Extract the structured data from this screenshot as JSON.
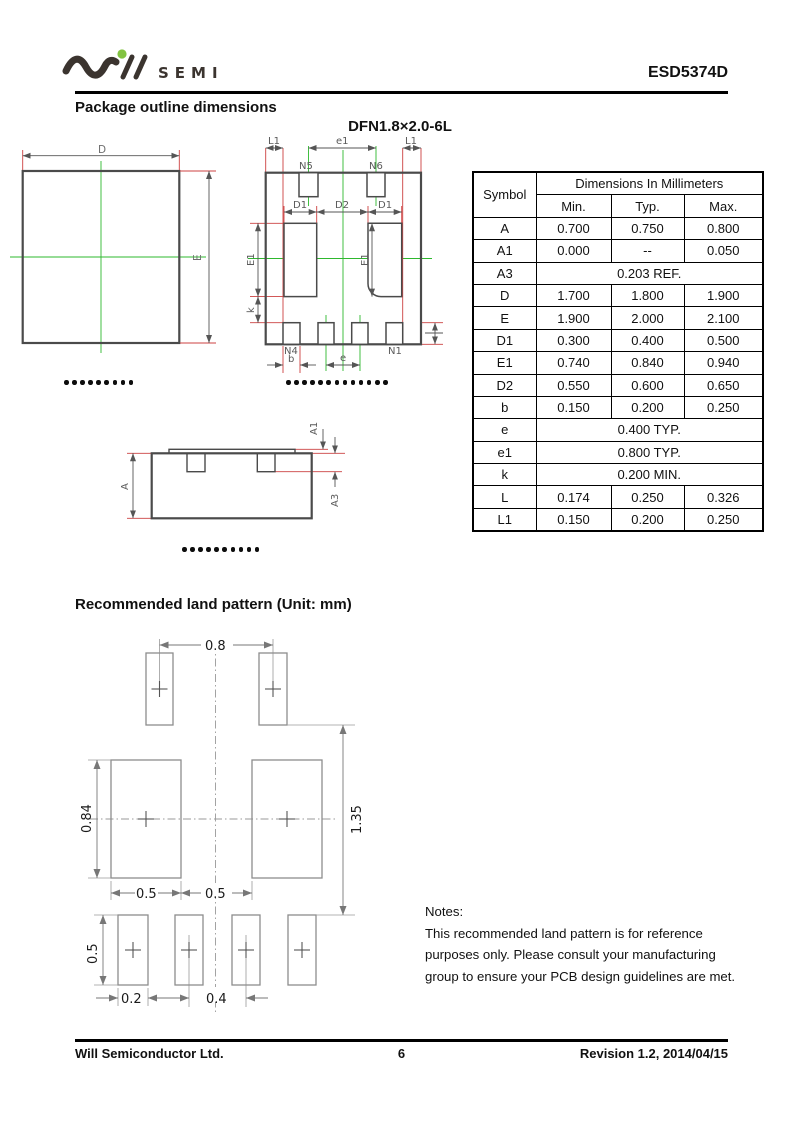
{
  "header": {
    "logo_text": "SEMI",
    "part_number": "ESD5374D"
  },
  "sections": {
    "outline_title": "Package outline dimensions",
    "package_name": "DFN1.8×2.0-6L",
    "land_pattern_title": "Recommended land pattern (Unit: mm)"
  },
  "drawings": {
    "top_view": {
      "dim_d": "D",
      "dim_e": "E"
    },
    "bottom_view": {
      "dim_l1_left": "L1",
      "dim_e1_top": "e1",
      "dim_l1_right": "L1",
      "pin_n5": "N5",
      "pin_n6": "N6",
      "dim_d1_left": "D1",
      "dim_d2": "D2",
      "dim_d1_right": "D1",
      "dim_e1_side": "E1",
      "dim_e1_inner": "E1",
      "dim_k": "k",
      "pin_n4": "N4",
      "pin_n1": "N1",
      "dim_b": "b",
      "dim_e": "e"
    },
    "side_view": {
      "dim_a": "A",
      "dim_a1": "A1",
      "dim_a3": "A3"
    }
  },
  "land_pattern": {
    "top_pitch": "0.8",
    "mid_pad_height": "0.84",
    "overall_height": "1.35",
    "mid_pad_width": "0.5",
    "mid_pad_gap": "0.5",
    "bottom_pad_height": "0.5",
    "bottom_pad_width": "0.2",
    "bottom_pitch": "0.4"
  },
  "dimension_table": {
    "header_symbol": "Symbol",
    "header_dims": "Dimensions In Millimeters",
    "col_min": "Min.",
    "col_typ": "Typ.",
    "col_max": "Max.",
    "rows": [
      {
        "symbol": "A",
        "min": "0.700",
        "typ": "0.750",
        "max": "0.800"
      },
      {
        "symbol": "A1",
        "min": "0.000",
        "typ": "--",
        "max": "0.050"
      },
      {
        "symbol": "A3",
        "span": "0.203 REF."
      },
      {
        "symbol": "D",
        "min": "1.700",
        "typ": "1.800",
        "max": "1.900"
      },
      {
        "symbol": "E",
        "min": "1.900",
        "typ": "2.000",
        "max": "2.100"
      },
      {
        "symbol": "D1",
        "min": "0.300",
        "typ": "0.400",
        "max": "0.500"
      },
      {
        "symbol": "E1",
        "min": "0.740",
        "typ": "0.840",
        "max": "0.940"
      },
      {
        "symbol": "D2",
        "min": "0.550",
        "typ": "0.600",
        "max": "0.650"
      },
      {
        "symbol": "b",
        "min": "0.150",
        "typ": "0.200",
        "max": "0.250"
      },
      {
        "symbol": "e",
        "span": "0.400 TYP."
      },
      {
        "symbol": "e1",
        "span": "0.800 TYP."
      },
      {
        "symbol": "k",
        "span": "0.200 MIN."
      },
      {
        "symbol": "L",
        "min": "0.174",
        "typ": "0.250",
        "max": "0.326"
      },
      {
        "symbol": "L1",
        "min": "0.150",
        "typ": "0.200",
        "max": "0.250"
      }
    ]
  },
  "notes": {
    "title": "Notes:",
    "line1": "This recommended land pattern is for reference",
    "line2": "purposes only. Please consult your manufacturing",
    "line3": "group to ensure your PCB design guidelines are met."
  },
  "footer": {
    "company": "Will Semiconductor Ltd.",
    "page_number": "6",
    "revision": "Revision 1.2, 2014/04/15"
  },
  "colors": {
    "extension_line_red": "#cc4040",
    "centerline_green": "#2eb82e",
    "logo_green": "#82c341",
    "logo_dark": "#3b342f",
    "land_pattern_gray": "#8d8d8d"
  }
}
